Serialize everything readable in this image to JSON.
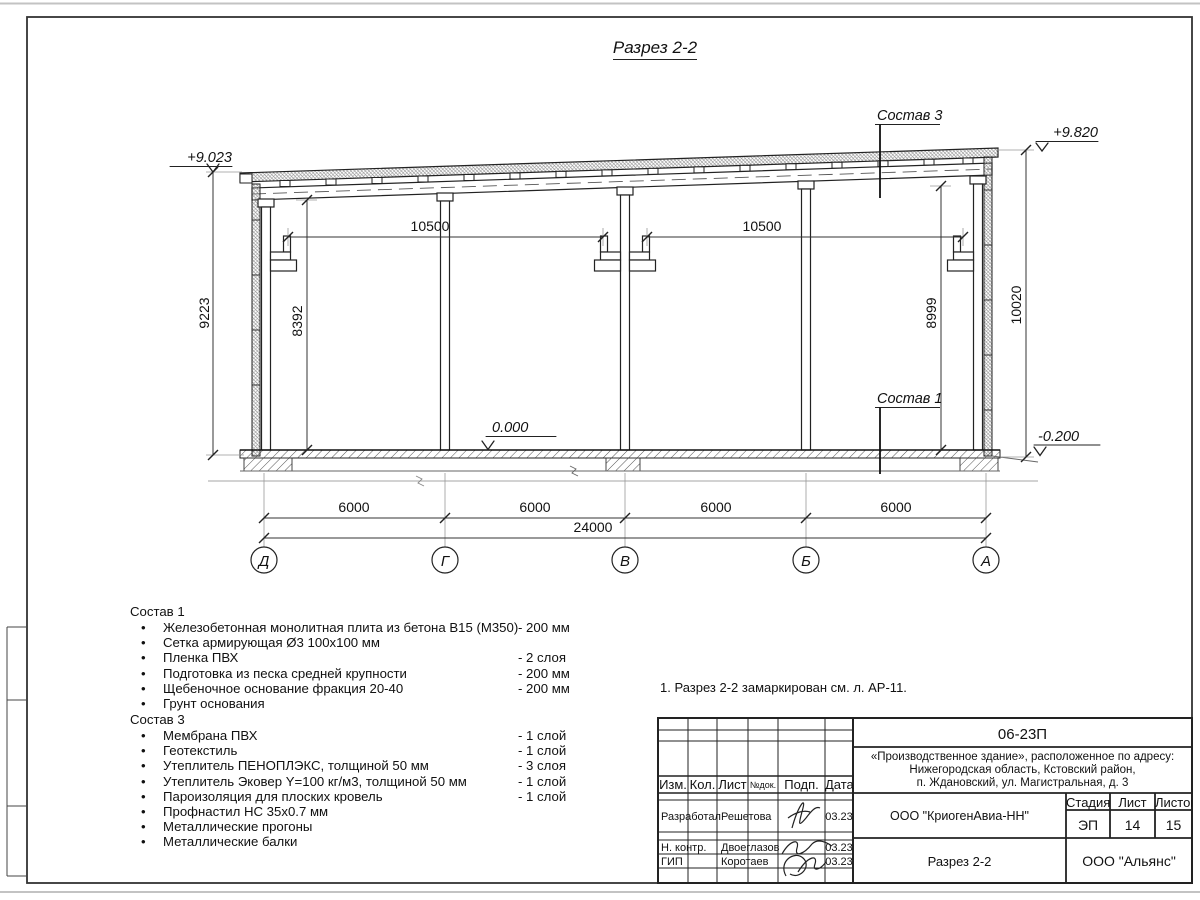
{
  "page": {
    "title": "Разрез 2-2"
  },
  "drawing": {
    "labels": {
      "sostav3": "Состав 3",
      "sostav1": "Состав 1"
    },
    "elevations": {
      "left_top": "+9.023",
      "right_top": "+9.820",
      "floor": "0.000",
      "ground": "-0.200"
    },
    "dims": {
      "span1": "10500",
      "span2": "10500",
      "left_outer": "9223",
      "left_inner": "8392",
      "right_inner": "8999",
      "right_outer": "10020",
      "bay": "6000",
      "total": "24000"
    },
    "axes": [
      "Д",
      "Г",
      "В",
      "Б",
      "А"
    ]
  },
  "lists": {
    "sostav1": {
      "title": "Состав 1",
      "items": [
        {
          "name": "Железобетонная монолитная плита из бетона В15 (М350)",
          "value": "-  200 мм"
        },
        {
          "name": "Сетка армирующая Ø3 100х100 мм",
          "value": ""
        },
        {
          "name": "Пленка ПВХ",
          "value": "-  2 слоя"
        },
        {
          "name": "Подготовка из песка средней крупности",
          "value": "- 200 мм"
        },
        {
          "name": "Щебеночное основание фракция 20-40",
          "value": "- 200 мм"
        },
        {
          "name": "Грунт основания",
          "value": ""
        }
      ]
    },
    "sostav3": {
      "title": "Состав 3",
      "items": [
        {
          "name": "Мембрана ПВХ",
          "value": "- 1 слой"
        },
        {
          "name": "Геотекстиль",
          "value": "- 1 слой"
        },
        {
          "name": "Утеплитель ПЕНОПЛЭКС, толщиной 50 мм",
          "value": "- 3 слоя"
        },
        {
          "name": "Утеплитель Эковер Y=100 кг/м3, толщиной 50 мм",
          "value": "- 1 слой"
        },
        {
          "name": "Пароизоляция для плоских кровель",
          "value": "- 1 слой"
        },
        {
          "name": "Профнастил НС 35х0.7 мм",
          "value": ""
        },
        {
          "name": "Металлические прогоны",
          "value": ""
        },
        {
          "name": "Металлические балки",
          "value": ""
        }
      ]
    }
  },
  "note": "1. Разрез 2-2 замаркирован см. л. АР-11.",
  "titleblock": {
    "code": "06-23П",
    "address_line1": "«Производственное здание», расположенное по адресу:",
    "address_line2": "Нижегородская область, Кстовский район,",
    "address_line3": "п. Ждановский, ул. Магистральная, д. 3",
    "org": "ООО \"КриогенАвиа-НН\"",
    "company": "ООО \"Альянс\"",
    "sheet_title": "Разрез 2-2",
    "cols": {
      "izm": "Изм.",
      "kol": "Кол.",
      "list": "Лист",
      "ndoc": "№док.",
      "podp": "Подп.",
      "data": "Дата"
    },
    "stage_label": "Стадия",
    "sheet_label": "Лист",
    "sheets_label": "Листов",
    "stage": "ЭП",
    "sheet": "14",
    "sheets": "15",
    "rows": [
      {
        "role": "Разработал",
        "name": "Решетова",
        "date": "03.23"
      },
      {
        "role": "Н. контр.",
        "name": "Двоеглазов",
        "date": "03.23"
      },
      {
        "role": "ГИП",
        "name": "Коротаев",
        "date": "03.23"
      }
    ]
  }
}
